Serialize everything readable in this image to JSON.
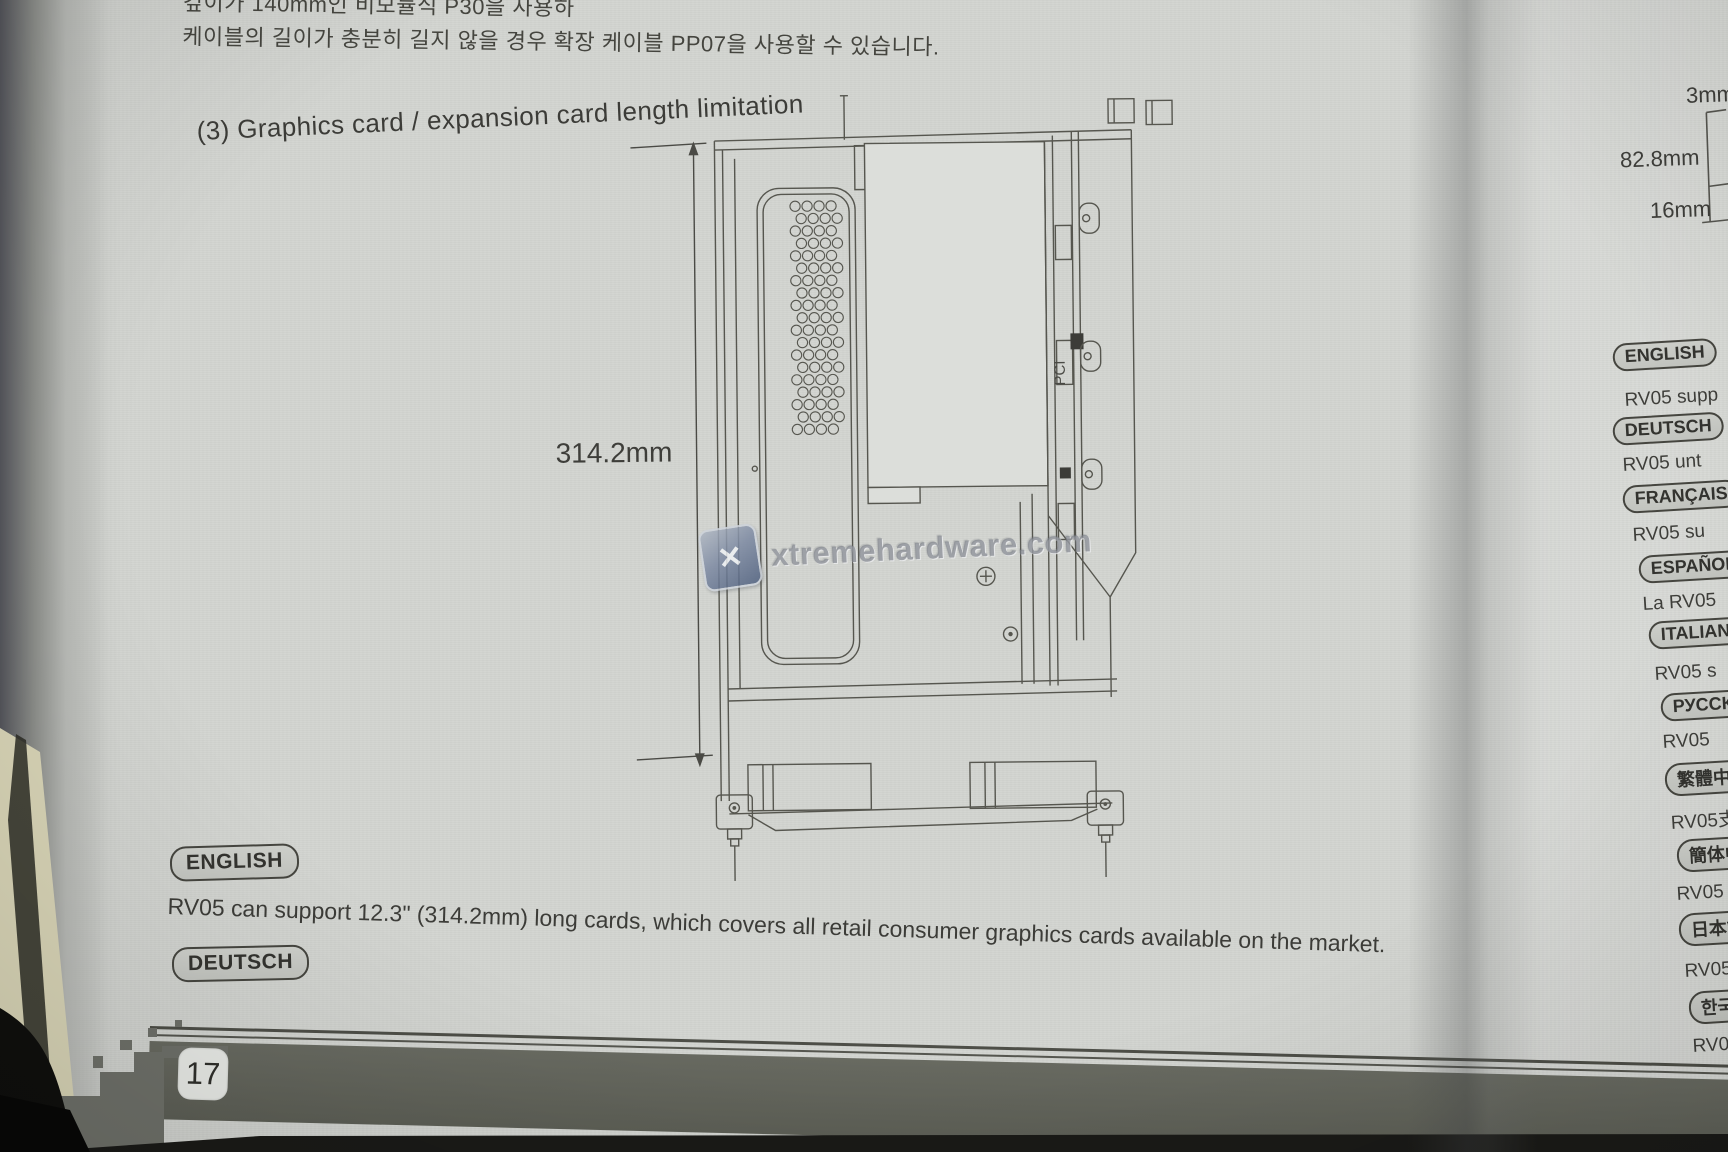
{
  "photo": {
    "korean_text": {
      "line1": "깊이가 140mm인 비모듈식 P30을 사용하",
      "line2": "케이블의 길이가 충분히 길지 않을 경우 확장 케이블 PP07을 사용할 수 있습니다."
    },
    "heading": "(3) Graphics card / expansion card length limitation",
    "diagram": {
      "dimension_label": "314.2mm",
      "pci_label": "PCI"
    },
    "side_dimensions": {
      "top": "3mm",
      "middle": "82.8mm",
      "bottom": "16mm"
    },
    "watermark": {
      "text": "xtremehardware.com",
      "logo_glyph": "✕"
    },
    "sections": [
      {
        "label": "ENGLISH",
        "text": "RV05 can support 12.3\" (314.2mm) long cards, which covers all retail consumer graphics cards available on the market."
      },
      {
        "label": "DEUTSCH",
        "text": "RV05 unterstützt Karten bis 12,3\" (314.2mm). Dies deckt alle auf dem Markt verfügbare Consumer-Grafikkarten ab."
      }
    ],
    "right_column": [
      {
        "label": "ENGLISH",
        "text": "RV05 supp"
      },
      {
        "label": "DEUTSCH",
        "text": "RV05 unt"
      },
      {
        "label": "FRANÇAIS",
        "text": "RV05 su"
      },
      {
        "label": "ESPAÑOL",
        "text": "La RV05"
      },
      {
        "label": "ITALIANO",
        "text": "RV05 s"
      },
      {
        "label": "РУССКИЙ",
        "text": "RV05"
      },
      {
        "label": "繁體中文",
        "text": "RV05支"
      },
      {
        "label": "簡体中文",
        "text": "RV05"
      },
      {
        "label": "日本語",
        "text": "RV05"
      },
      {
        "label": "한국어",
        "text": "RV0"
      }
    ],
    "page_number": "17",
    "colors": {
      "paper": "#d3d5d1",
      "band": "#62645b",
      "ink": "#3c3c38",
      "watermark_blue": "#4e5f7e"
    }
  }
}
